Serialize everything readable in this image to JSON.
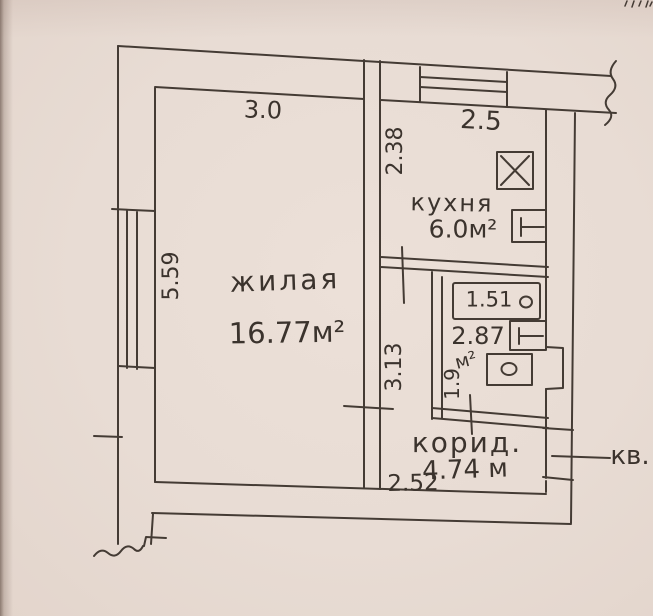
{
  "document": {
    "type": "hand-drawn apartment floor plan (scanned photo)",
    "paper_color": "#e8dcd4",
    "ink_color": "#443b34"
  },
  "rooms": {
    "living": {
      "label": "жилая",
      "area": "16.77м²"
    },
    "kitchen": {
      "label": "кухня",
      "area": "6.0м²"
    },
    "bathroom": {
      "area": "2.87",
      "area_unit": "м²"
    },
    "corridor": {
      "label": "корид.",
      "area": "4.74 м"
    }
  },
  "dims": {
    "living_width": "3.0",
    "kitchen_width": "2.5",
    "kitchen_depth": "2.38",
    "living_depth": "5.59",
    "inner_wall": "3.13",
    "bathroom_depth": "1.9",
    "bathtub_length": "1.51",
    "corridor_width": "2.52"
  },
  "entrance": {
    "label": "кв."
  },
  "fixtures": {
    "stove": "stove-icon",
    "kitchen_sink": "kitchen-sink-icon",
    "bathtub": "bathtub-icon",
    "wash_basin": "wash-basin-icon",
    "toilet": "toilet-icon",
    "window_left": "window-hatch-icon",
    "window_kitchen": "window-hatch-icon"
  }
}
